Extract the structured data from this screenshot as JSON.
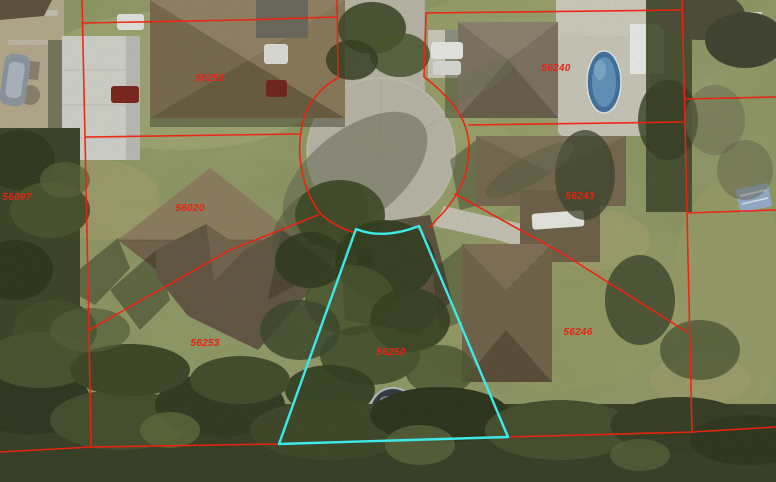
{
  "colors": {
    "parcel_line": "#f0220e",
    "selected_parcel_line": "#3fe9ea",
    "label_text": "#e92212"
  },
  "parcels": {
    "selected_id": "56250",
    "labels": [
      {
        "id": "56256"
      },
      {
        "id": "56240"
      },
      {
        "id": "56243"
      },
      {
        "id": "56246"
      },
      {
        "id": "56250"
      },
      {
        "id": "56253"
      },
      {
        "id": "56020"
      },
      {
        "id": "56097"
      }
    ]
  }
}
